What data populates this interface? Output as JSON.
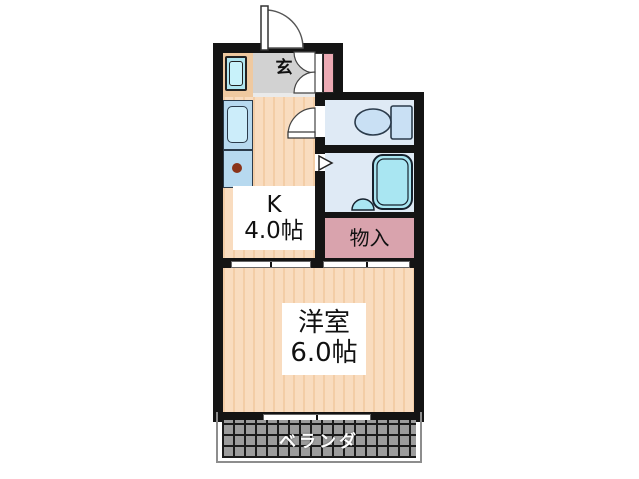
{
  "plan_title": "1K apartment floor plan",
  "rooms": {
    "entrance": {
      "label": "玄"
    },
    "kitchen": {
      "line1": "K",
      "line2": "4.0帖"
    },
    "toilet": {
      "fixture": "toilet-icon"
    },
    "bathroom": {
      "fixture": "bathtub-icon"
    },
    "storage": {
      "label": "物入"
    },
    "western_room": {
      "line1": "洋室",
      "line2": "6.0帖"
    },
    "balcony": {
      "label": "ベランダ"
    }
  },
  "fixtures": [
    "washing-machine-icon",
    "sink-icon",
    "stove-burner-icon",
    "toilet-icon",
    "bathtub-icon",
    "bath-drain-icon"
  ],
  "doors": [
    "entrance-swing-door",
    "shoe-cabinet-double-door",
    "kitchen-swing-door",
    "bathroom-folding-door-marker",
    "sliding-door-kitchen-room",
    "sliding-door-storage-room",
    "sliding-window-balcony"
  ],
  "colors": {
    "wall": "#141414",
    "floor_peach": "#f9dcbf",
    "floor_stripe": "#f3cda6",
    "entrance_gray": "#d2d2d2",
    "wet_room_blue": "#dfeaf5",
    "fixture_blue": "#c9e0f4",
    "bathtub_cyan": "#a9e6f2",
    "storage_pink": "#d9a3ad",
    "accent_pink": "#ecaab4",
    "counter_blue": "#b7d9ef",
    "balcony_gray": "#9c9c9c",
    "balcony_text": "#ffffff"
  }
}
